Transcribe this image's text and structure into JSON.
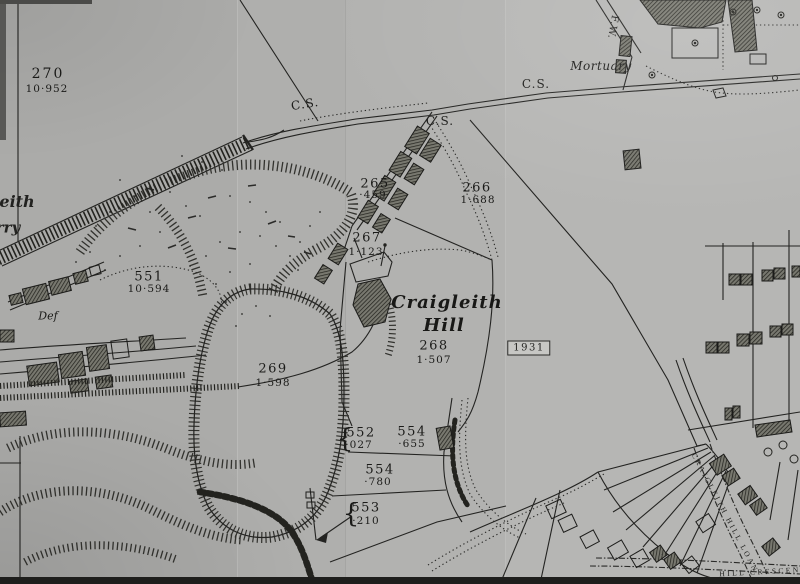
{
  "map": {
    "stamp": "1931",
    "region_name": {
      "line1": "Craigleith",
      "line2": "Hill"
    },
    "labels": {
      "mortuary": "Mortuary",
      "fw": "F.W.",
      "cs": "C.S.",
      "def": "Def",
      "quarry_fragment_top": "leith",
      "quarry_fragment_bottom": "rry",
      "street_loan": "CRAIGLEITH HILL LOAN",
      "street_crescent": "HILL CRESCEN",
      "brace": "{"
    },
    "parcels": {
      "p270": {
        "id": "270",
        "area": "10·952"
      },
      "p551": {
        "id": "551",
        "area": "10·594"
      },
      "p265": {
        "id": "265",
        "area": "·459"
      },
      "p266": {
        "id": "266",
        "area": "1·688"
      },
      "p267": {
        "id": "267",
        "area": "1·123"
      },
      "p268": {
        "id": "268",
        "area": "1·507"
      },
      "p269": {
        "id": "269",
        "area": "1·598"
      },
      "p552": {
        "id": "552",
        "area": "·027"
      },
      "p553": {
        "id": "553",
        "area": "·210"
      },
      "p554a": {
        "id": "554",
        "area": "·655"
      },
      "p554b": {
        "id": "554",
        "area": "·780"
      }
    },
    "colors": {
      "ink": "#1e1e1c",
      "paper": "#b2b2b0"
    }
  }
}
